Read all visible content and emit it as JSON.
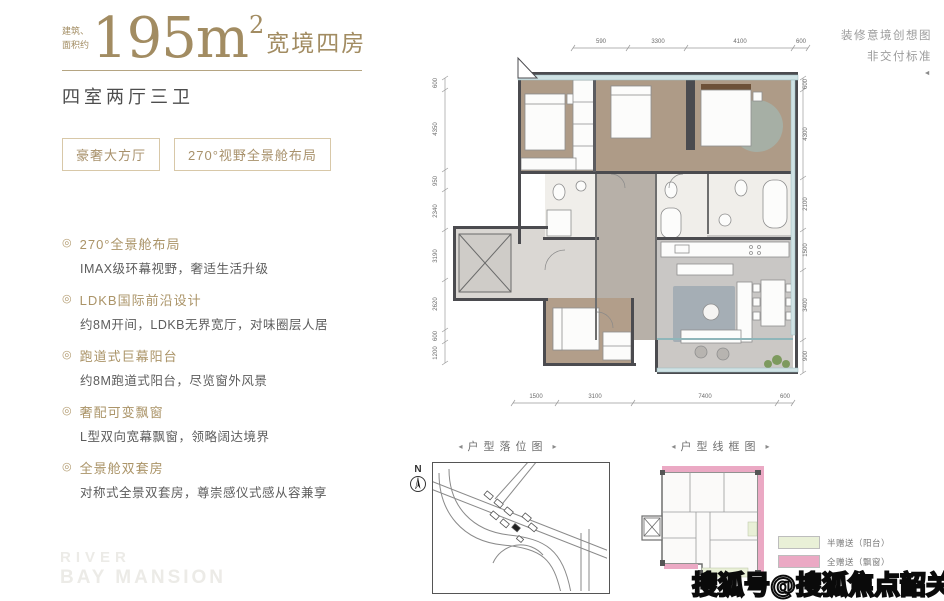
{
  "header": {
    "area_note_line1": "建筑、",
    "area_note_line2": "面积约",
    "area_value": "195m",
    "area_exponent": "2",
    "area_title": "宽境四房",
    "rooms_line": "四室两厅三卫",
    "tags": [
      "豪奢大方厅",
      "270°视野全景舱布局"
    ]
  },
  "disclaimer": {
    "line1": "装修意境创想图",
    "line2": "非交付标准",
    "mark": "◄"
  },
  "features": [
    {
      "title": "270°全景舱布局",
      "desc": "IMAX级环幕视野，奢适生活升级"
    },
    {
      "title": "LDKB国际前沿设计",
      "desc": "约8M开间，LDKB无界宽厅，对味圈层人居"
    },
    {
      "title": "跑道式巨幕阳台",
      "desc": "约8M跑道式阳台，尽览窗外风景"
    },
    {
      "title": "奢配可变飘窗",
      "desc": "L型双向宽幕飘窗，领略阔达境界"
    },
    {
      "title": "全景舱双套房",
      "desc": "对称式全景双套房，尊崇感仪式感从容兼享"
    }
  ],
  "icons": {
    "bullet": "◎",
    "arrow_left": "◂",
    "arrow_right": "▸"
  },
  "floorplan": {
    "dims_top": [
      "590",
      "3300",
      "4100",
      "600"
    ],
    "dims_left": [
      "600",
      "4350",
      "950",
      "2340",
      "3190",
      "2620",
      "600",
      "1200"
    ],
    "dims_right": [
      "600",
      "4300",
      "2100",
      "1500",
      "3400",
      "900"
    ],
    "dims_bottom": [
      "1500",
      "3100",
      "7400",
      "600"
    ]
  },
  "map_panel": {
    "title": "户型落位图",
    "compass_label": "N"
  },
  "wireframe_panel": {
    "title": "户型线框图",
    "legend": [
      {
        "label": "半赠送（阳台）",
        "color": "#e9f0d7"
      },
      {
        "label": "全赠送（飘窗）",
        "color": "#eba9c4"
      }
    ]
  },
  "watermarks": {
    "brand_line1": "RIVER",
    "brand_line2": "BAY MANSION",
    "sohu": "搜狐号@搜狐焦点韶关站"
  },
  "colors": {
    "accent_gold": "#a28c62",
    "wall": "#4b4b4f",
    "wood_floor": "#ae9b87",
    "gray_floor": "#c9c7c5",
    "window_band": "#cfe2e4",
    "gift_pink": "#eba9c4",
    "gift_green": "#e9f0d7"
  }
}
